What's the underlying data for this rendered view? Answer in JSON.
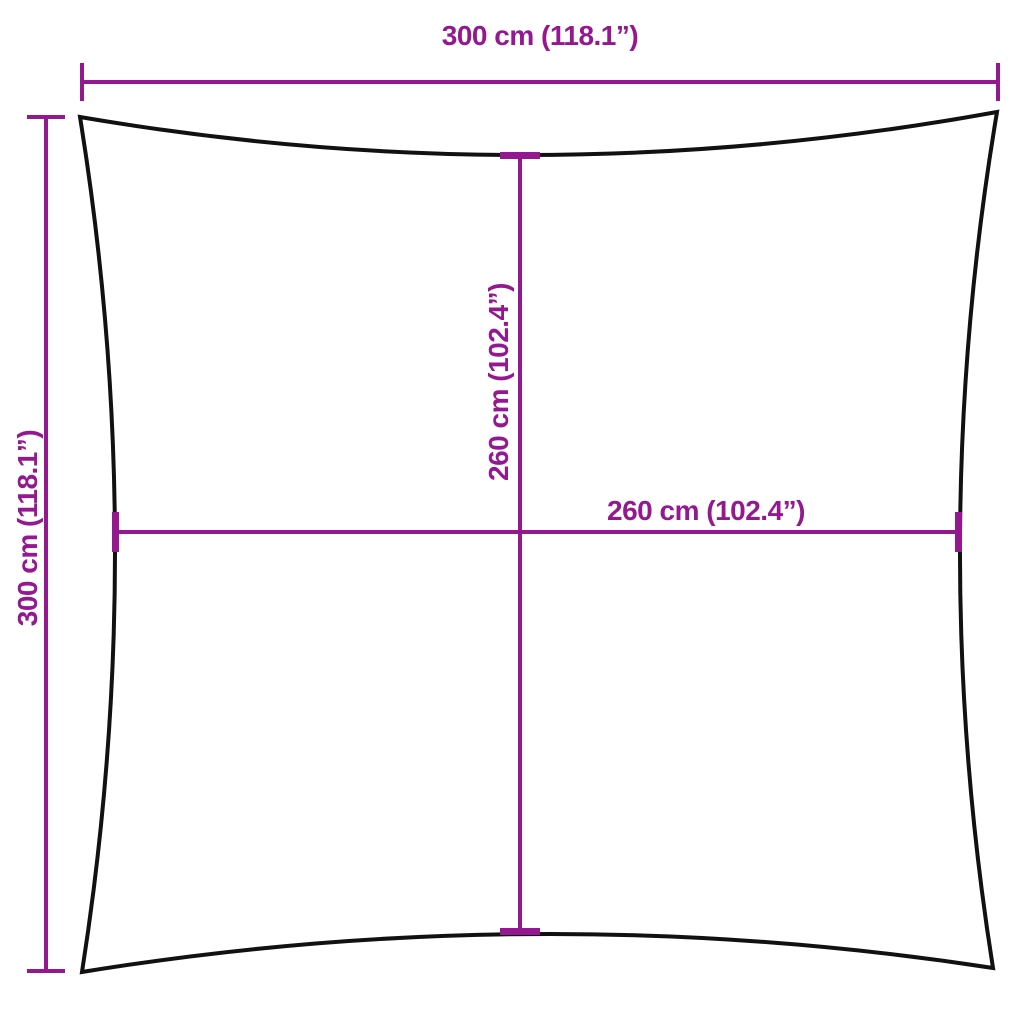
{
  "diagram": {
    "type": "product-dimension-diagram",
    "shape": "square-shade-sail-concave-edges",
    "labels": {
      "width_top": "300 cm (118.1”)",
      "height_left": "300 cm (118.1”)",
      "inner_vertical": "260 cm (102.4”)",
      "inner_horizontal": "260 cm (102.4”)"
    }
  },
  "colors": {
    "dimension": "#941890",
    "outline": "#111111",
    "background": "#ffffff"
  }
}
